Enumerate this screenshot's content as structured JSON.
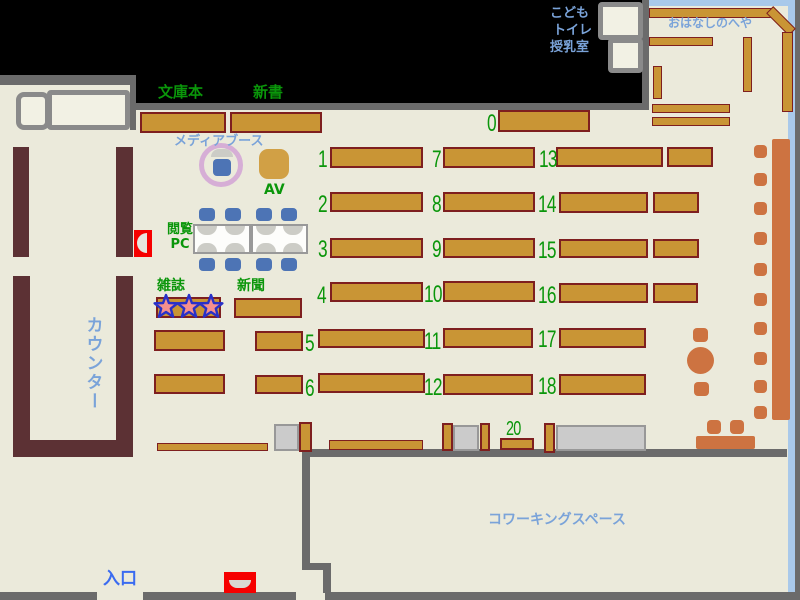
{
  "labels": {
    "counter": "カウンター",
    "entrance": "入口",
    "coworking": "コワーキングスペース",
    "story_room": "おはなしのへや",
    "kids": "こども",
    "toilet": "トイレ",
    "nursing": "授乳室",
    "paperback": "文庫本",
    "shinsho": "新書",
    "media_booth": "メディアブース",
    "av": "AV",
    "pc_line1": "閲覧",
    "pc_line2": "PC",
    "magazine": "雑誌",
    "newspaper": "新聞"
  },
  "shelf_numbers": {
    "s0": "0",
    "s1": "1",
    "s2": "2",
    "s3": "3",
    "s4": "4",
    "s5": "5",
    "s6": "6",
    "s7": "7",
    "s8": "8",
    "s9": "9",
    "s10": "10",
    "s11": "11",
    "s12": "12",
    "s13": "13",
    "s14": "14",
    "s15": "15",
    "s16": "16",
    "s17": "17",
    "s18": "18",
    "s20": "20"
  },
  "colors": {
    "background": "#000000",
    "floor": "#ebeadb",
    "wall": "#6b6b6b",
    "shelf_fill": "#c99535",
    "shelf_border": "#7e1f1f",
    "counter": "#5c3134",
    "seat_orange": "#cd7341",
    "chair_blue": "#4d74b5",
    "av_booth": "#d1a045",
    "media_ring": "#d6aed6",
    "gray_table": "#cbcbcb",
    "window_blue": "#a9c9ea",
    "text_green": "#0a960a",
    "text_lightblue": "#7aa3d9",
    "text_entrance_blue": "#3a6bf0",
    "alert_red": "#f60000",
    "star_fill": "#f58f8d",
    "star_border": "#2830c8"
  }
}
